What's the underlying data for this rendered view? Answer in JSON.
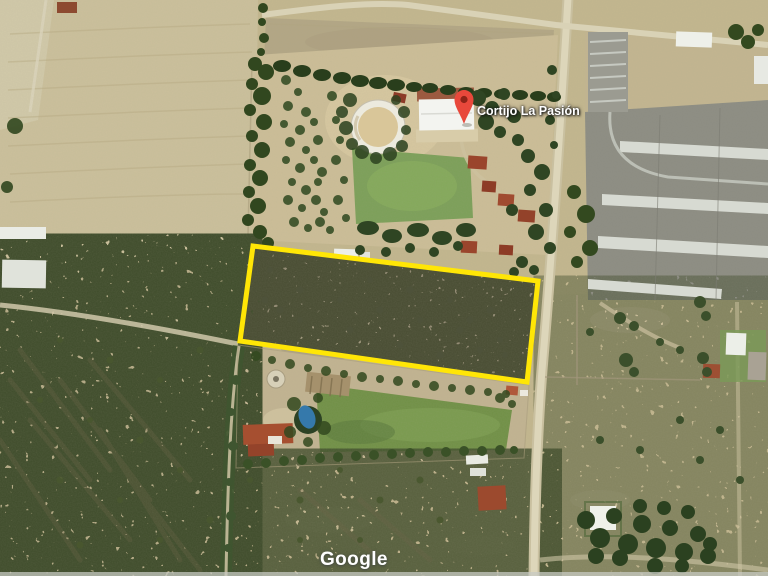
{
  "map": {
    "view": "satellite",
    "place": {
      "label": "Cortijo La Pasión"
    },
    "watermark": "Google",
    "boundary": {
      "shape": "quadrilateral",
      "points": "253,246 538,281 527,382 240,341"
    },
    "colors": {
      "boundary-yellow": "#FFE606",
      "pin-red": "#E8483B",
      "pin-core": "#8E2418",
      "label-text": "#FFFFFF",
      "watermark-text": "#FFFFFF"
    }
  }
}
